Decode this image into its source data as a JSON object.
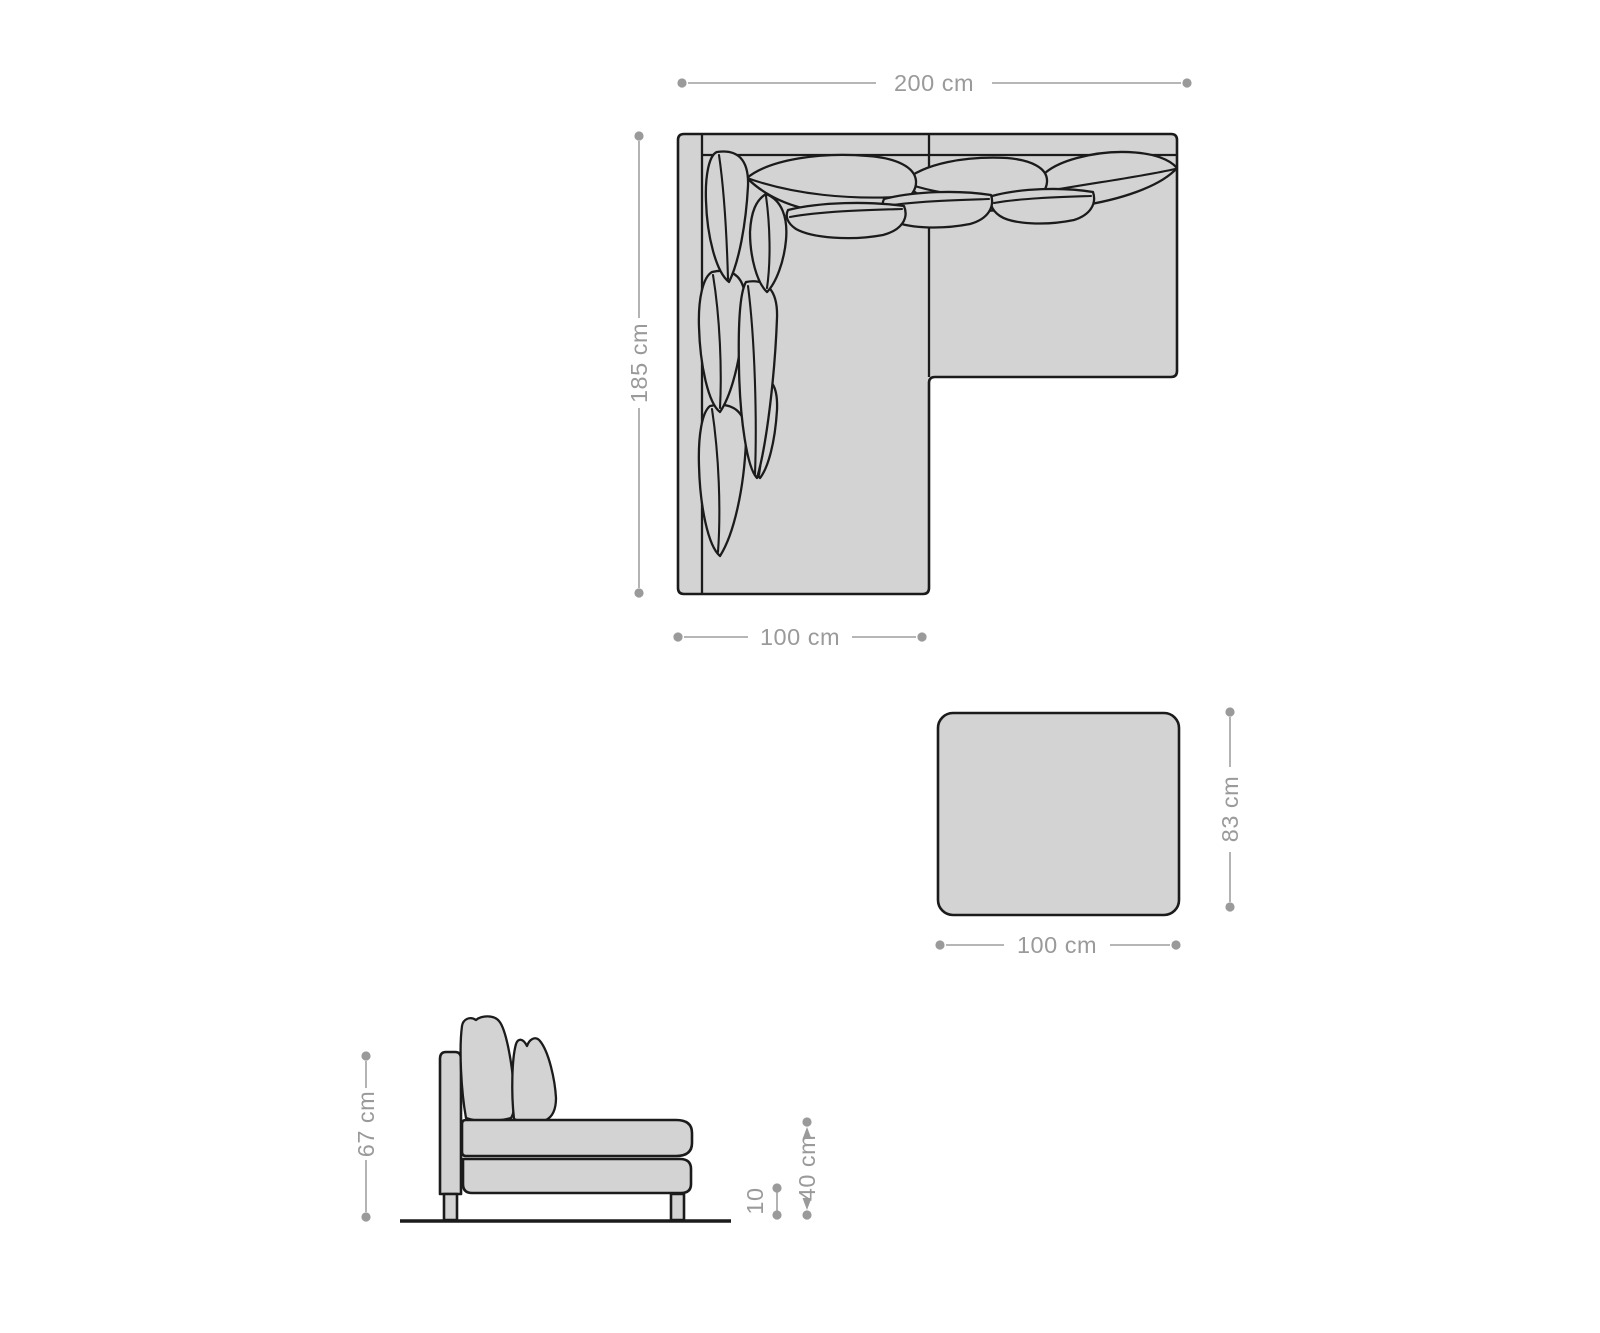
{
  "diagram": {
    "sofa_top_view": {
      "width_label": "200 cm",
      "depth_label": "185 cm",
      "section_width_label": "100 cm"
    },
    "ottoman_top_view": {
      "width_label": "100 cm",
      "depth_label": "83 cm"
    },
    "sofa_side_view": {
      "height_label": "67 cm",
      "seat_height_label": "40 cm",
      "leg_height_label": "10"
    },
    "colors": {
      "background": "#ffffff",
      "furniture_fill": "#d3d3d3",
      "outline": "#1b1b1b",
      "dimension_text": "#9a9a9a",
      "dimension_line": "#ababab"
    }
  }
}
